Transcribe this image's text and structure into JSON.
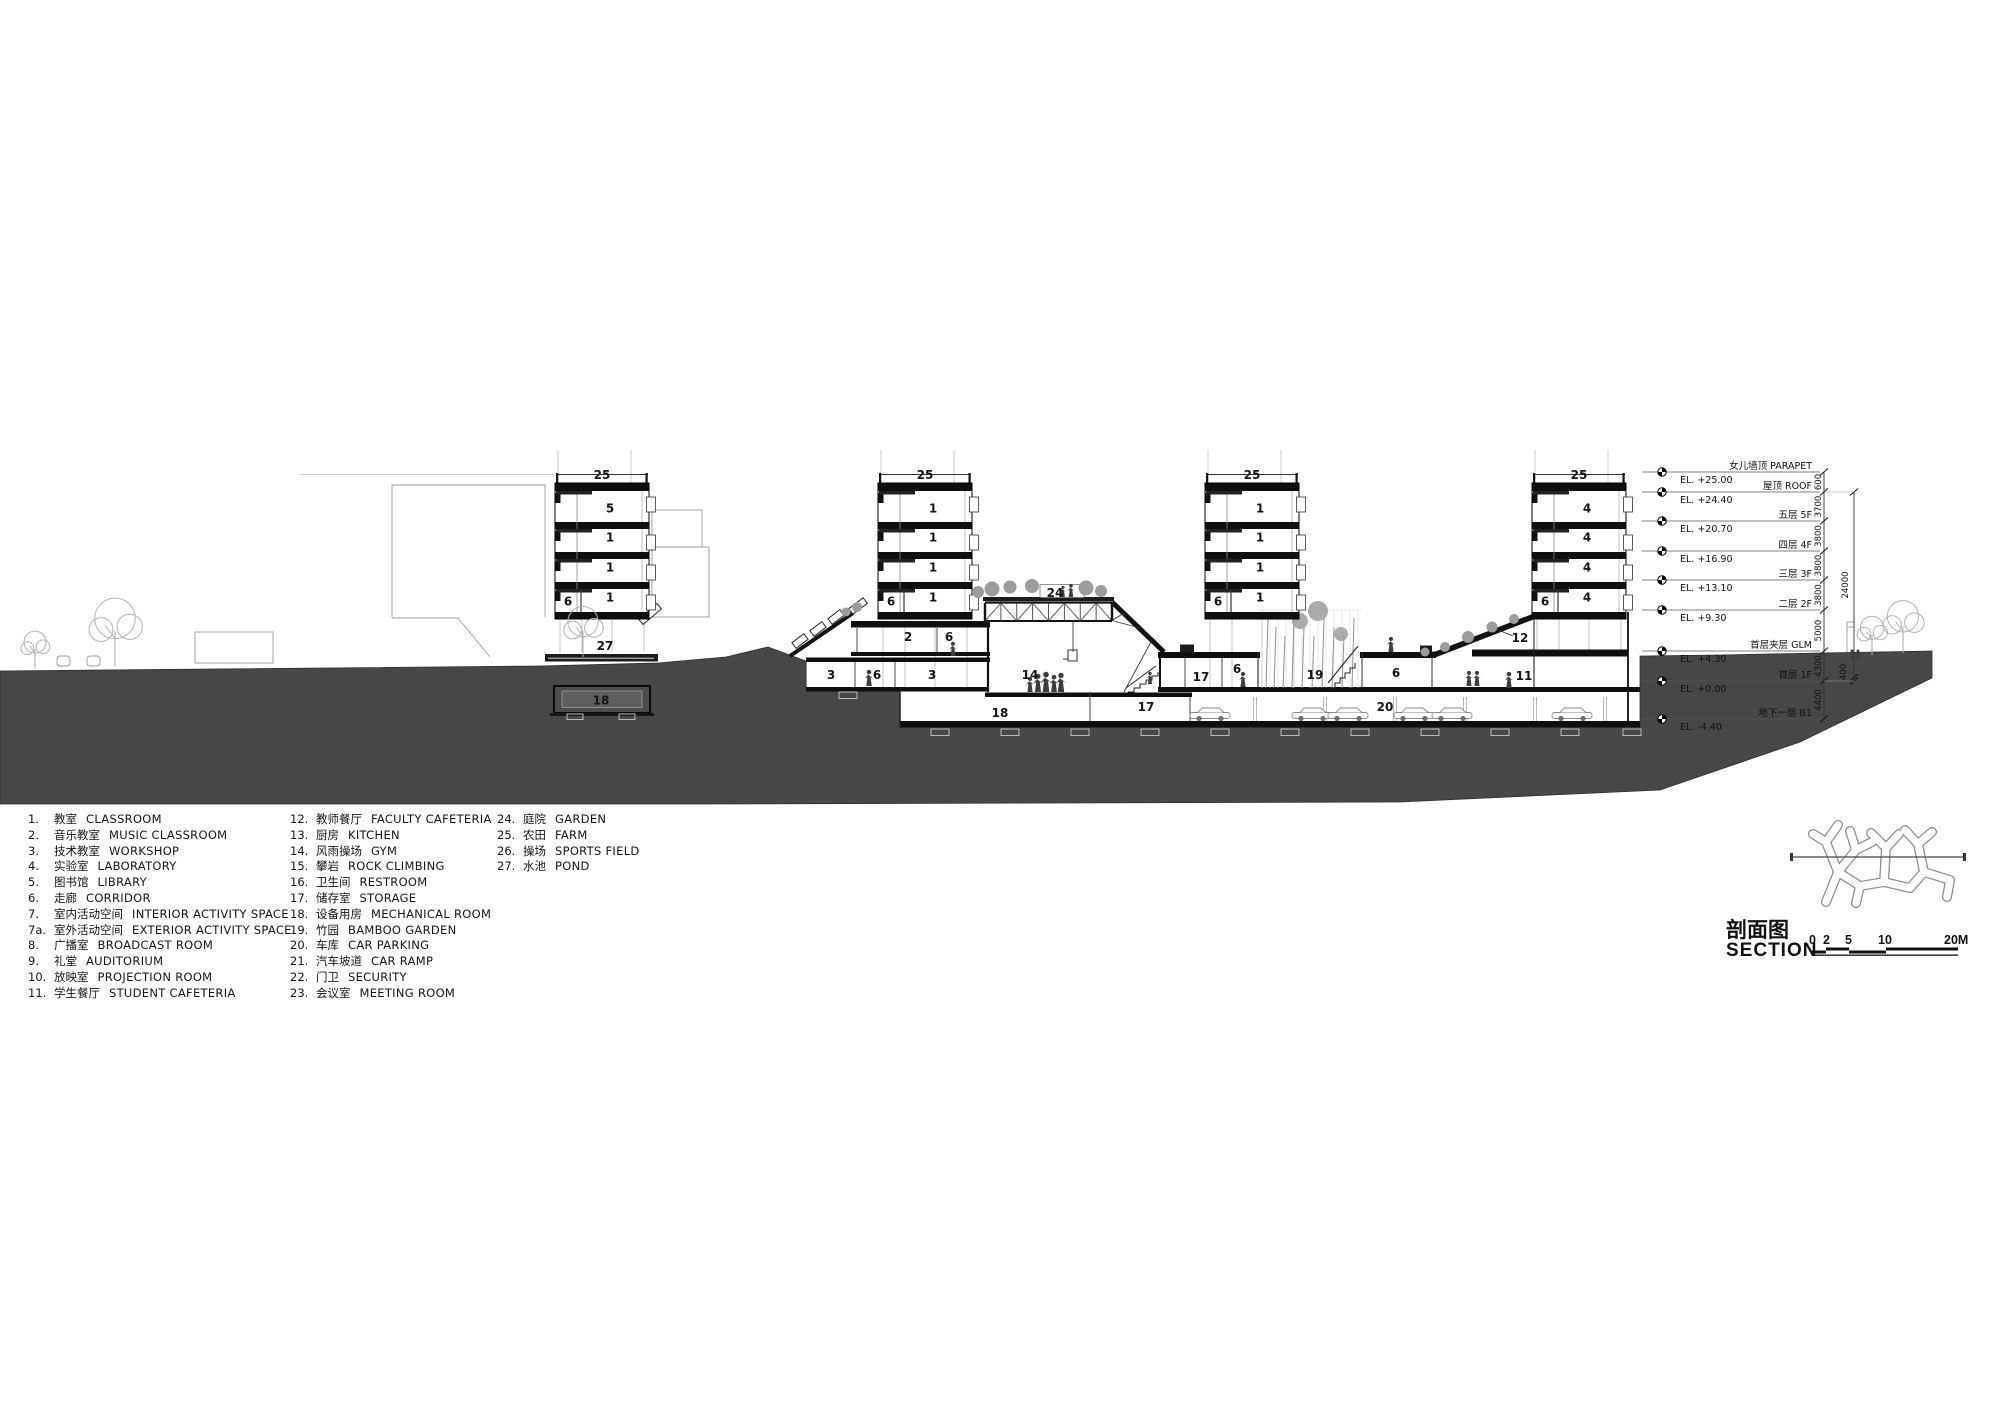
{
  "drawing_title": {
    "zh": "剖面图",
    "en": "SECTION"
  },
  "scale_bar": {
    "labels": [
      "0",
      "2",
      "5",
      "10",
      "20M"
    ]
  },
  "legend": {
    "columns": [
      [
        {
          "no": "1.",
          "zh": "教室",
          "en": "CLASSROOM"
        },
        {
          "no": "2.",
          "zh": "音乐教室",
          "en": "MUSIC CLASSROOM"
        },
        {
          "no": "3.",
          "zh": "技术教室",
          "en": "WORKSHOP"
        },
        {
          "no": "4.",
          "zh": "实验室",
          "en": "LABORATORY"
        },
        {
          "no": "5.",
          "zh": "图书馆",
          "en": "LIBRARY"
        },
        {
          "no": "6.",
          "zh": "走廊",
          "en": "CORRIDOR"
        },
        {
          "no": "7.",
          "zh": "室内活动空间",
          "en": "INTERIOR ACTIVITY SPACE"
        },
        {
          "no": "7a.",
          "zh": "室外活动空间",
          "en": "EXTERIOR ACTIVITY SPACE"
        },
        {
          "no": "8.",
          "zh": "广播室",
          "en": "BROADCAST ROOM"
        },
        {
          "no": "9.",
          "zh": "礼堂",
          "en": "AUDITORIUM"
        },
        {
          "no": "10.",
          "zh": "放映室",
          "en": "PROJECTION ROOM"
        },
        {
          "no": "11.",
          "zh": "学生餐厅",
          "en": "STUDENT CAFETERIA"
        }
      ],
      [
        {
          "no": "12.",
          "zh": "教师餐厅",
          "en": "FACULTY CAFETERIA"
        },
        {
          "no": "13.",
          "zh": "厨房",
          "en": "KITCHEN"
        },
        {
          "no": "14.",
          "zh": "风雨操场",
          "en": "GYM"
        },
        {
          "no": "15.",
          "zh": "攀岩",
          "en": "ROCK CLIMBING"
        },
        {
          "no": "16.",
          "zh": "卫生间",
          "en": "RESTROOM"
        },
        {
          "no": "17.",
          "zh": "储存室",
          "en": "STORAGE"
        },
        {
          "no": "18.",
          "zh": "设备用房",
          "en": "MECHANICAL ROOM"
        },
        {
          "no": "19.",
          "zh": "竹园",
          "en": "BAMBOO GARDEN"
        },
        {
          "no": "20.",
          "zh": "车库",
          "en": "CAR PARKING"
        },
        {
          "no": "21.",
          "zh": "汽车坡道",
          "en": "CAR RAMP"
        },
        {
          "no": "22.",
          "zh": "门卫",
          "en": "SECURITY"
        },
        {
          "no": "23.",
          "zh": "会议室",
          "en": "MEETING ROOM"
        }
      ],
      [
        {
          "no": "24.",
          "zh": "庭院",
          "en": "GARDEN"
        },
        {
          "no": "25.",
          "zh": "农田",
          "en": "FARM"
        },
        {
          "no": "26.",
          "zh": "操场",
          "en": "SPORTS FIELD"
        },
        {
          "no": "27.",
          "zh": "水池",
          "en": "POND"
        }
      ]
    ]
  },
  "levels": [
    {
      "label": "女儿墙顶 PARAPET",
      "el": "EL. +25.00"
    },
    {
      "label": "屋顶 ROOF",
      "el": "EL. +24.40"
    },
    {
      "label": "五层 5F",
      "el": "EL. +20.70"
    },
    {
      "label": "四层 4F",
      "el": "EL. +16.90"
    },
    {
      "label": "三层 3F",
      "el": "EL. +13.10"
    },
    {
      "label": "二层 2F",
      "el": "EL. +9.30"
    },
    {
      "label": "首层夹层 GLM",
      "el": "EL. +4.30"
    },
    {
      "label": "首层 1F",
      "el": "EL. +0.00"
    },
    {
      "label": "地下一层 B1",
      "el": "EL. -4.40"
    }
  ],
  "dimensions": {
    "segments": [
      "600",
      "3700",
      "3800",
      "3800",
      "3800",
      "5000",
      "4300",
      "4400"
    ],
    "overall": "24000",
    "minor": "400"
  },
  "rooms": {
    "t1": {
      "roof": "25",
      "f5": "5",
      "f4": "1",
      "f3": "1",
      "f2": "1",
      "f2l": "6",
      "pond": "27",
      "tank": "18"
    },
    "t2": {
      "roof": "25",
      "f5": "1",
      "f4": "1",
      "f3": "1",
      "f2": "1",
      "f2l": "6"
    },
    "t3": {
      "roof": "25",
      "f5": "1",
      "f4": "1",
      "f3": "1",
      "f2": "1",
      "f2l": "6",
      "bamboo": "19",
      "corr": "6",
      "parking": "20"
    },
    "t4": {
      "roof": "25",
      "f5": "4",
      "f4": "4",
      "f3": "4",
      "f2": "4",
      "f2l": "6",
      "faculty_cafeteria": "12",
      "student_cafeteria": "11"
    },
    "mid": {
      "mezz_music": "2",
      "mezz_corridor": "6",
      "ground_workshop_a": "3",
      "ground_corridor": "6",
      "ground_workshop_b": "3",
      "basement_mech": "18",
      "roof_garden": "24",
      "gym": "14",
      "basement_storage": "17",
      "ground_storage": "17",
      "ground_corridor_b": "6"
    }
  }
}
